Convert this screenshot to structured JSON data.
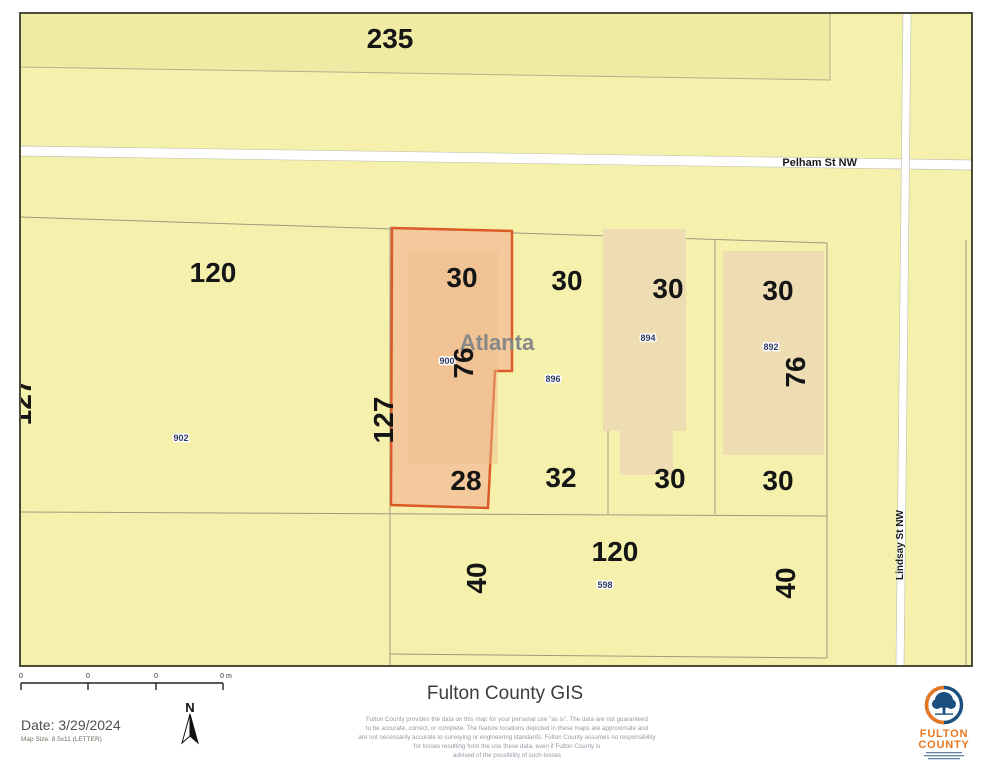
{
  "map": {
    "block_label": "235",
    "city_label": "Atlanta",
    "streets": {
      "pelham": "Pelham St NW",
      "lindsay": "Lindsay St NW"
    },
    "parcel_ids": {
      "p902": "902",
      "p900": "900",
      "p896": "896",
      "p894": "894",
      "p892": "892",
      "p598": "598"
    },
    "dimensions": {
      "p902_front": "120",
      "p902_side": "127",
      "p900_side": "127",
      "p900_top": "30",
      "p900_depth": "76",
      "p900_bottom": "28",
      "p896_top": "30",
      "p896_bottom": "32",
      "p894_top": "30",
      "p894_bottom": "30",
      "p892_top": "30",
      "p892_depth": "76",
      "p892_bottom": "30",
      "p598_front": "120",
      "p598_left": "40",
      "p598_right": "40"
    },
    "colors": {
      "parcel_yellow": "#f5f1ad",
      "block_yellow": "#f0eba4",
      "highlight_fill": "#f4c99b",
      "highlight_stroke": "#dc5a28",
      "footprint_tan": "#eedcb2",
      "boundary_line": "#9c9c7e",
      "road_white": "#ffffff"
    }
  },
  "footer": {
    "title": "Fulton County GIS",
    "date_label": "Date: 3/29/2024",
    "map_size_label": "Map Size: 8.5x11 (LETTER)",
    "north_label": "N",
    "scale_ticks": [
      "0",
      "0",
      "0",
      "0 m"
    ],
    "disclaimer_lines": [
      "Fulton County provides the data on this map for your personal use \"as is\". The data are not guaranteed",
      "to be accurate, correct, or complete. The feature locations depicted in these maps are approximate and",
      "are not necessarily accurate to surveying or engineering standards. Fulton County assumes no responsibility",
      "for losses resulting from the use these data, even if Fulton County is",
      "advised of the possibility of such losses"
    ],
    "logo": {
      "name_line1": "FULTON",
      "name_line2": "COUNTY",
      "colors": {
        "orange": "#e87722",
        "blue": "#1b4f7e"
      }
    }
  }
}
